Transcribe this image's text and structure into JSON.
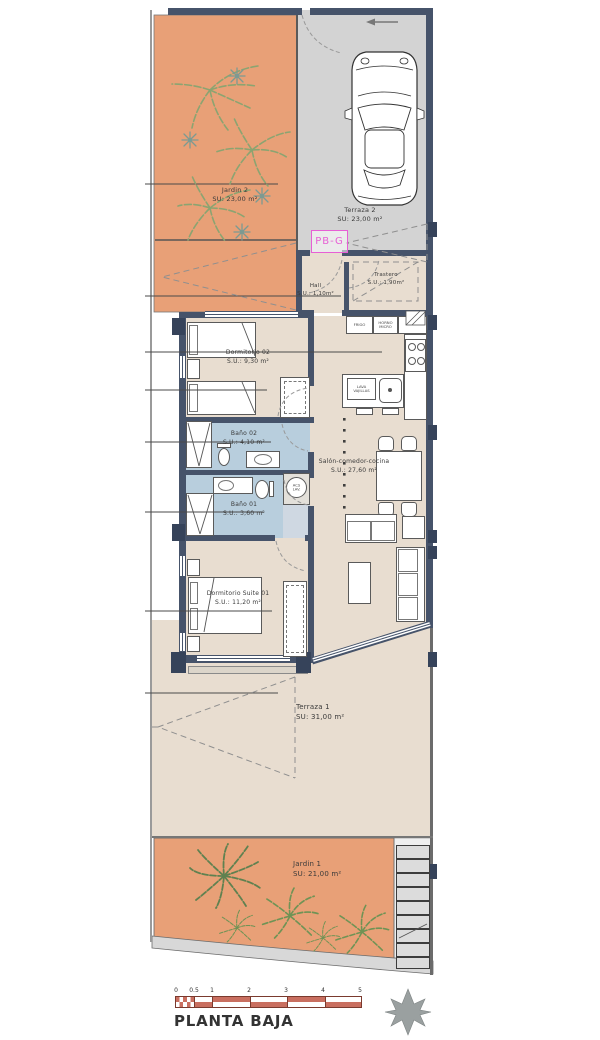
{
  "title": "PLANTA BAJA",
  "unit_label": "PB-G",
  "rooms": {
    "jardin2": {
      "name": "Jardin 2",
      "area": "SU: 23,00 m²"
    },
    "terraza2": {
      "name": "Terraza 2",
      "area": "SU: 23,00 m²"
    },
    "hall": {
      "name": "Hall",
      "area": "S.U.: 1,10m²"
    },
    "trastero": {
      "name": "Trastero",
      "area": "S.U.: 1,90m²"
    },
    "dormitorio02": {
      "name": "Dormitorio 02",
      "area": "S.U.: 9,30 m²"
    },
    "bano02": {
      "name": "Baño 02",
      "area": "S.U.: 4,10 m²"
    },
    "bano01": {
      "name": "Baño 01",
      "area": "S.U.: 3,60 m²"
    },
    "salon": {
      "name": "Salón-comedor-cocina",
      "area": "S.U.: 27,60 m²"
    },
    "suite01": {
      "name": "Dormitorio Suite 01",
      "area": "S.U.: 11,20 m²"
    },
    "terraza1": {
      "name": "Terraza 1",
      "area": "SU: 31,00 m²"
    },
    "jardin1": {
      "name": "Jardin 1",
      "area": "SU: 21,00 m²"
    }
  },
  "kitchen": {
    "fridge": "FRIGO",
    "oven_micro": "HORNO\nMICRO",
    "dishwasher": "LAVA\nVAJILLAS"
  },
  "utility": {
    "water_heater": "ACS\nLAV."
  },
  "scale": {
    "ticks": [
      "0",
      "0.5",
      "1",
      "2",
      "3",
      "4",
      "5"
    ]
  },
  "colors": {
    "garden_orange": "#e8a077",
    "terrace_gray": "#d3d3d3",
    "floor_beige": "#e8ddd0",
    "bath_blue": "#b8cedd",
    "wall_dark": "#46536a",
    "accent_magenta": "#e75fd5",
    "scale_red": "#c96f60",
    "plant_green": "#8ba471"
  }
}
